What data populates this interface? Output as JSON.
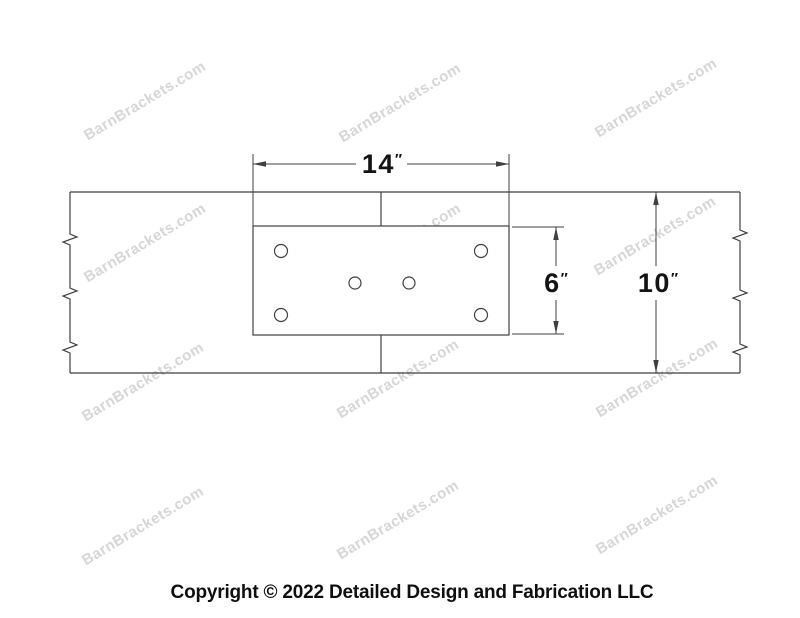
{
  "watermark": {
    "text": "BarnBrackets.com",
    "color": "#d6d6d6"
  },
  "colors": {
    "line": "#3f3f3f",
    "dim_text": "#141414"
  },
  "drawing": {
    "dimensions": {
      "plate_width": {
        "value": "14",
        "unit": "″"
      },
      "plate_height": {
        "value": "6",
        "unit": "″"
      },
      "beam_height": {
        "value": "10",
        "unit": "″"
      }
    },
    "bolt_hole_count": "6"
  },
  "footer": {
    "copyright": "Copyright © 2022 Detailed Design and Fabrication LLC"
  }
}
